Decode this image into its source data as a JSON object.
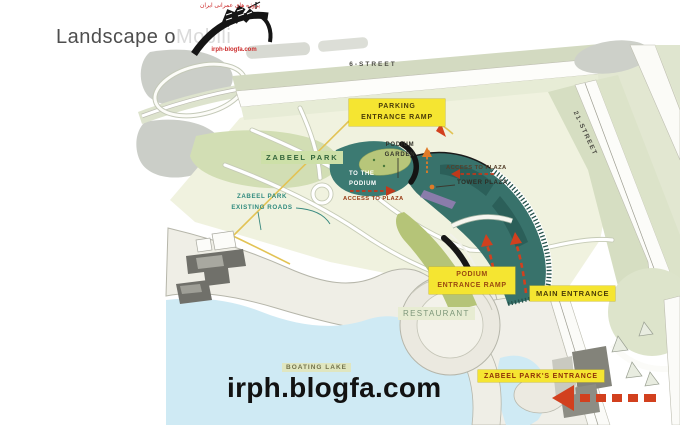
{
  "header": {
    "title_primary": "Landscape o",
    "title_watermark": "Mobili",
    "logo": {
      "tagline_farsi": "پروژه های عمرانی ایران",
      "site": "irph-blogfa.com"
    }
  },
  "map": {
    "streets": {
      "street_6": "6-STREET",
      "street_21": "21-STREET"
    },
    "areas": {
      "zabeel_park": "ZABEEL PARK",
      "restaurant": "RESTAURANT",
      "boating_lake": "BOATING LAKE",
      "podium_garden_line1": "PODIUM",
      "podium_garden_line2": "GARDEN",
      "to_the_podium_line1": "TO THE",
      "to_the_podium_line2": "PODIUM",
      "tower_plaza": "TOWER PLAZA",
      "existing_roads_line1": "ZABEEL PARK",
      "existing_roads_line2": "EXISTING ROADS"
    },
    "entrances": {
      "parking_ramp_line1": "PARKING",
      "parking_ramp_line2": "ENTRANCE RAMP",
      "podium_ramp_line1": "PODIUM",
      "podium_ramp_line2": "ENTRANCE RAMP",
      "main_entrance": "MAIN ENTRANCE",
      "park_entrance": "ZABEEL PARK'S ENTRANCE",
      "access_to_plaza_west": "ACCESS TO PLAZA",
      "access_to_plaza_east": "ACCESS TO PLAZA"
    }
  },
  "watermark": "irph.blogfa.com",
  "colors": {
    "callout_yellow": "#f5e531",
    "arrow_red": "#d2401e",
    "development_teal": "#38726b",
    "park_green": "#d2deb4",
    "lawn_olive": "#b5c478",
    "lake_blue": "#cfeaf4",
    "boundary_gold": "#e2c355"
  }
}
